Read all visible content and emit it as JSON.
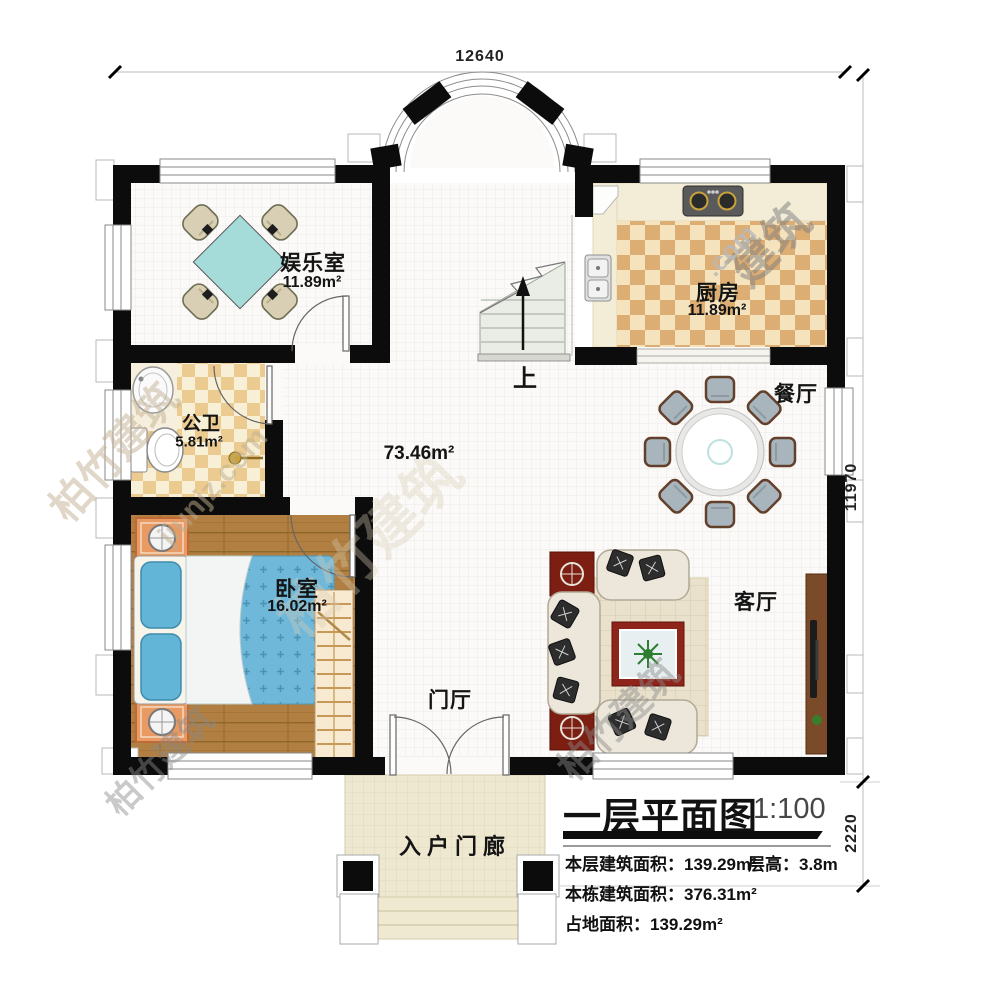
{
  "dimensions": {
    "top": "12640",
    "right": "11970",
    "porch_depth": "2220"
  },
  "rooms": {
    "entertainment": {
      "name": "娱乐室",
      "area": "11.89m²"
    },
    "kitchen": {
      "name": "厨房",
      "area": "11.89m²"
    },
    "bathroom": {
      "name": "公卫",
      "area": "5.81m²"
    },
    "bedroom": {
      "name": "卧室",
      "area": "16.02m²"
    },
    "hall": {
      "area": "73.46m²"
    },
    "dining": {
      "name": "餐厅"
    },
    "living": {
      "name": "客厅"
    },
    "foyer": {
      "name": "门厅"
    },
    "porch": {
      "name": "入户门廊"
    }
  },
  "stairs": {
    "up_label": "上"
  },
  "title_block": {
    "title": "一层平面图",
    "scale": "1:100",
    "line1_label": "本层建筑面积：",
    "line1_value": "139.29m²",
    "line1_extra_label": "层高：",
    "line1_extra_value": "3.8m",
    "line2_label": "本栋建筑面积：",
    "line2_value": "376.31m²",
    "line3_label": "占地面积：",
    "line3_value": "139.29m²"
  },
  "watermarks": [
    "jiunjz.com",
    "柏竹建筑",
    "建筑",
    ".com"
  ]
}
